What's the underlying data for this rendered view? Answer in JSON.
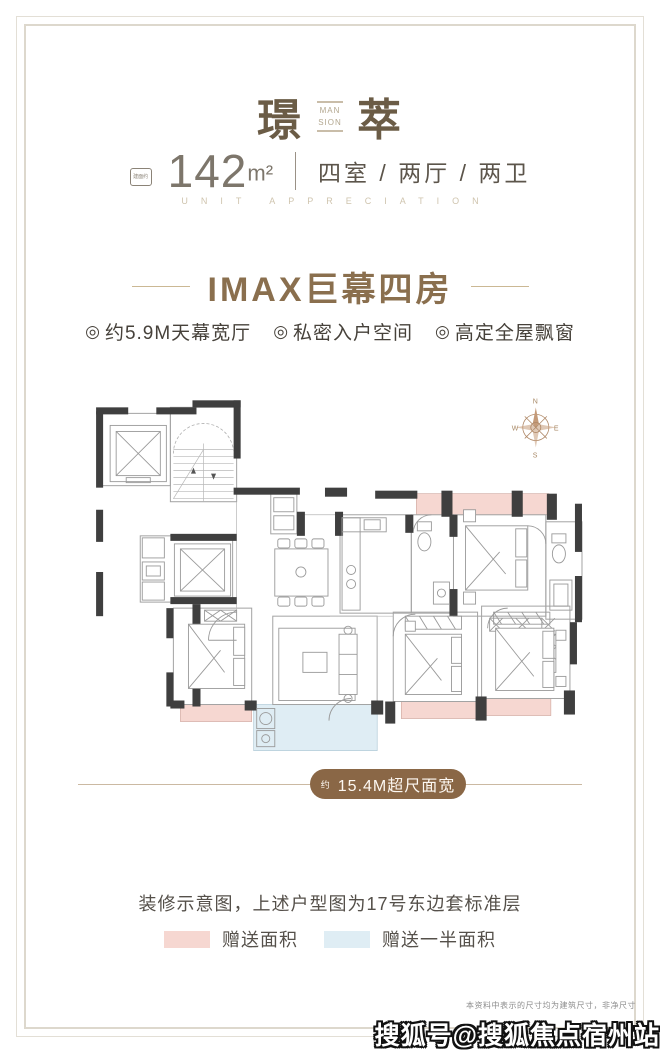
{
  "header": {
    "title_left": "璟",
    "title_right": "萃",
    "divider_en_top": "MAN",
    "divider_en_bottom": "SION",
    "area_badge": "建面约",
    "area_value": "142",
    "area_unit": "m²",
    "layout_text": "四室 / 两厅 / 两卫",
    "subtitle_en": "UNIT APPRECIATION"
  },
  "selling_points": {
    "headline": "IMAX巨幕四房",
    "features": [
      {
        "icon": "◎",
        "label": "约5.9M天幕宽厅"
      },
      {
        "icon": "◎",
        "label": "私密入户空间"
      },
      {
        "icon": "◎",
        "label": "高定全屋飘窗"
      }
    ]
  },
  "floor_plan": {
    "compass": {
      "n": "N",
      "w": "W",
      "e": "E",
      "s": "S"
    },
    "width_label_prefix": "约",
    "width_label": "15.4M超尺面宽",
    "colors": {
      "gift_area": "#f6d7d1",
      "half_gift_area": "#dfedf4",
      "wall": "#3f3f3f",
      "accent_brown": "#8a6746"
    }
  },
  "footer": {
    "caption": "装修示意图，上述户型图为17号东边套标准层",
    "legend": [
      {
        "label": "赠送面积",
        "color": "#f6d7d1"
      },
      {
        "label": "赠送一半面积",
        "color": "#dfedf4"
      }
    ],
    "disclaimer": "本资料中表示的尺寸均为建筑尺寸，非净尺寸",
    "watermark": "搜狐号@搜狐焦点宿州站"
  }
}
